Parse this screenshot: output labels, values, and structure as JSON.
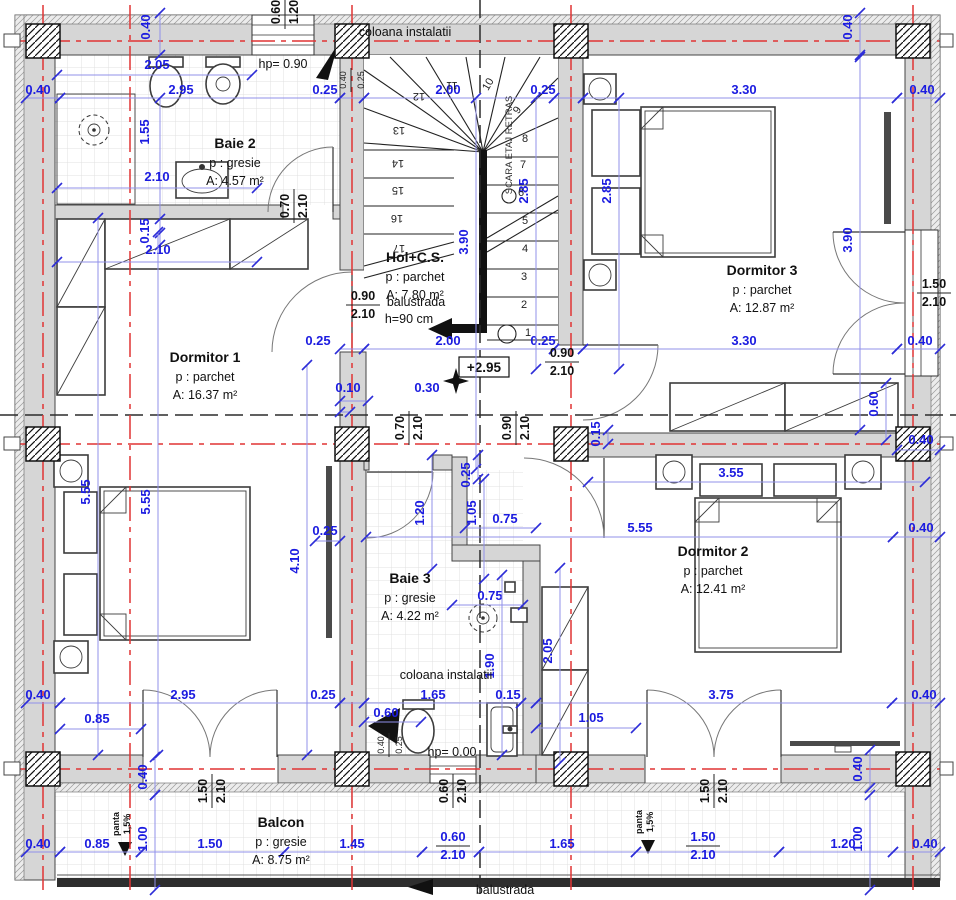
{
  "drawing": {
    "level_marker": "+2.95",
    "colors": {
      "dim_blue": "#1b1be0",
      "axis_red": "#e03434",
      "wall_gray": "#d6d6d6",
      "hatch_black": "#111111"
    }
  },
  "rooms": [
    {
      "name": "Baie 2",
      "floor": "p : gresie",
      "area": "A: 4.57 m²",
      "x": 235,
      "y": 148
    },
    {
      "name": "Hol+C.S.",
      "floor": "p : parchet",
      "area": "A: 7.80 m²",
      "x": 415,
      "y": 262
    },
    {
      "name": "Dormitor 3",
      "floor": "p : parchet",
      "area": "A: 12.87 m²",
      "x": 762,
      "y": 275
    },
    {
      "name": "Dormitor 1",
      "floor": "p : parchet",
      "area": "A: 16.37 m²",
      "x": 205,
      "y": 362
    },
    {
      "name": "Dormitor 2",
      "floor": "p : parchet",
      "area": "A: 12.41 m²",
      "x": 713,
      "y": 556
    },
    {
      "name": "Baie 3",
      "floor": "p : gresie",
      "area": "A: 4.22 m²",
      "x": 410,
      "y": 583
    },
    {
      "name": "Balcon",
      "floor": "p : gresie",
      "area": "A: 8.75 m²",
      "x": 281,
      "y": 827
    }
  ],
  "annotations": [
    {
      "t": "coloana instalatii",
      "x": 405,
      "y": 36,
      "r": 0,
      "c": "ann"
    },
    {
      "t": "coloana instalatii",
      "x": 446,
      "y": 679,
      "r": 0,
      "c": "ann"
    },
    {
      "t": "hp= 0.90",
      "x": 283,
      "y": 68,
      "r": 0,
      "c": "ann"
    },
    {
      "t": "hp= 0.00",
      "x": 452,
      "y": 756,
      "r": 0,
      "c": "ann"
    },
    {
      "t": "balustrada",
      "x": 416,
      "y": 306,
      "r": 0,
      "c": "ann"
    },
    {
      "t": "h=90 cm",
      "x": 409,
      "y": 323,
      "r": 0,
      "c": "ann"
    },
    {
      "t": "balustrada",
      "x": 505,
      "y": 894,
      "r": 0,
      "c": "ann"
    },
    {
      "t": "SCARA ETAJ RETRAS",
      "x": 512,
      "y": 145,
      "r": -90,
      "c": "ann-s"
    },
    {
      "t": "panta",
      "x": 119,
      "y": 824,
      "r": -90,
      "c": "ann-p"
    },
    {
      "t": "1,5%",
      "x": 130,
      "y": 824,
      "r": -90,
      "c": "ann-p"
    },
    {
      "t": "panta",
      "x": 642,
      "y": 822,
      "r": -90,
      "c": "ann-p"
    },
    {
      "t": "1,5%",
      "x": 653,
      "y": 822,
      "r": -90,
      "c": "ann-p"
    }
  ],
  "dims": [
    {
      "t": "0.40",
      "x": 38,
      "y": 94,
      "l": [
        26,
        98,
        60,
        98
      ]
    },
    {
      "t": "2.95",
      "x": 181,
      "y": 94,
      "l": [
        60,
        98,
        340,
        98
      ]
    },
    {
      "t": "0.25",
      "x": 325,
      "y": 94,
      "l": [
        340,
        98,
        364,
        98
      ]
    },
    {
      "t": "2.00",
      "x": 448,
      "y": 94,
      "l": [
        364,
        98,
        554,
        98
      ]
    },
    {
      "t": "0.25",
      "x": 543,
      "y": 94,
      "l": [
        554,
        98,
        583,
        98
      ]
    },
    {
      "t": "3.30",
      "x": 744,
      "y": 94,
      "l": [
        583,
        98,
        897,
        98
      ]
    },
    {
      "t": "0.40",
      "x": 922,
      "y": 94,
      "l": [
        897,
        98,
        940,
        98
      ]
    },
    {
      "t": "0.25",
      "x": 318,
      "y": 345,
      "l": [
        340,
        349,
        364,
        349
      ]
    },
    {
      "t": "2.00",
      "x": 448,
      "y": 345,
      "l": [
        364,
        349,
        554,
        349
      ]
    },
    {
      "t": "0.25",
      "x": 543,
      "y": 345,
      "l": [
        554,
        349,
        583,
        349
      ]
    },
    {
      "t": "3.30",
      "x": 744,
      "y": 345,
      "l": [
        583,
        349,
        897,
        349
      ]
    },
    {
      "t": "0.40",
      "x": 920,
      "y": 345,
      "l": [
        897,
        349,
        940,
        349
      ]
    },
    {
      "t": "0.30",
      "x": 427,
      "y": 392,
      "l": [
        340,
        401,
        368,
        401
      ]
    },
    {
      "t": "0.10",
      "x": 348,
      "y": 392,
      "l": [
        340,
        412,
        350,
        412
      ]
    },
    {
      "t": "2.05",
      "x": 157,
      "y": 69,
      "l": [
        57,
        75,
        252,
        75
      ]
    },
    {
      "t": "1.55",
      "x": 149,
      "y": 132,
      "r": -90,
      "l": [
        160,
        98,
        160,
        245
      ]
    },
    {
      "t": "2.10",
      "x": 157,
      "y": 181,
      "l": [
        57,
        188,
        257,
        188
      ]
    },
    {
      "t": "0.15",
      "x": 149,
      "y": 231,
      "r": -90,
      "l": [
        160,
        219,
        160,
        233
      ]
    },
    {
      "t": "2.10",
      "x": 158,
      "y": 254,
      "l": [
        57,
        262,
        257,
        262
      ]
    },
    {
      "t": "0.40",
      "x": 150,
      "y": 27,
      "r": -90,
      "l": [
        160,
        13,
        160,
        55
      ]
    },
    {
      "t": "0.40",
      "x": 852,
      "y": 27,
      "r": -90,
      "l": [
        860,
        13,
        860,
        55
      ]
    },
    {
      "t": "2.85",
      "x": 528,
      "y": 191,
      "r": -90,
      "l": [
        536,
        98,
        536,
        369
      ]
    },
    {
      "t": "2.85",
      "x": 611,
      "y": 191,
      "r": -90,
      "l": [
        619,
        98,
        619,
        369
      ]
    },
    {
      "t": "3.90",
      "x": 468,
      "y": 242,
      "r": -90,
      "l": [
        476,
        98,
        476,
        469
      ]
    },
    {
      "t": "3.90",
      "x": 852,
      "y": 240,
      "r": -90,
      "l": [
        860,
        57,
        860,
        430
      ]
    },
    {
      "t": "0.60",
      "x": 878,
      "y": 404,
      "r": -90,
      "l": [
        886,
        383,
        886,
        440
      ]
    },
    {
      "t": "0.15",
      "x": 600,
      "y": 434,
      "r": -90,
      "l": [
        608,
        430,
        608,
        444
      ]
    },
    {
      "t": "0.40",
      "x": 921,
      "y": 444,
      "l": [
        897,
        450,
        940,
        450
      ]
    },
    {
      "t": "5.55",
      "x": 90,
      "y": 492,
      "r": -90,
      "l": [
        98,
        218,
        98,
        755
      ]
    },
    {
      "t": "5.55",
      "x": 150,
      "y": 502,
      "r": -90,
      "l": [
        158,
        232,
        158,
        755
      ]
    },
    {
      "t": "4.10",
      "x": 299,
      "y": 561,
      "r": -90,
      "l": [
        307,
        365,
        307,
        755
      ]
    },
    {
      "t": "0.25",
      "x": 325,
      "y": 535,
      "l": [
        315,
        541,
        340,
        541
      ]
    },
    {
      "t": "3.55",
      "x": 731,
      "y": 477,
      "l": [
        588,
        482,
        925,
        482
      ]
    },
    {
      "t": "5.55",
      "x": 640,
      "y": 532,
      "l": [
        366,
        537,
        893,
        537
      ]
    },
    {
      "t": "0.40",
      "x": 921,
      "y": 532,
      "l": [
        893,
        537,
        940,
        537
      ]
    },
    {
      "t": "1.20",
      "x": 424,
      "y": 513,
      "r": -90,
      "l": [
        432,
        455,
        432,
        569
      ]
    },
    {
      "t": "0.25",
      "x": 470,
      "y": 475,
      "r": -90,
      "l": [
        478,
        455,
        478,
        479
      ]
    },
    {
      "t": "1.05",
      "x": 476,
      "y": 513,
      "r": -90,
      "l": [
        484,
        479,
        484,
        579
      ]
    },
    {
      "t": "0.75",
      "x": 505,
      "y": 523,
      "l": [
        465,
        528,
        536,
        528
      ]
    },
    {
      "t": "0.75",
      "x": 490,
      "y": 600,
      "l": [
        452,
        605,
        523,
        605
      ]
    },
    {
      "t": "2.05",
      "x": 552,
      "y": 651,
      "r": -90,
      "l": [
        560,
        568,
        560,
        763
      ]
    },
    {
      "t": "1.90",
      "x": 494,
      "y": 666,
      "r": -90,
      "l": [
        502,
        575,
        502,
        755
      ]
    },
    {
      "t": "0.40",
      "x": 38,
      "y": 699,
      "l": [
        26,
        703,
        60,
        703
      ]
    },
    {
      "t": "2.95",
      "x": 183,
      "y": 699,
      "l": [
        60,
        703,
        340,
        703
      ]
    },
    {
      "t": "0.25",
      "x": 323,
      "y": 699,
      "l": [
        340,
        703,
        364,
        703
      ]
    },
    {
      "t": "1.65",
      "x": 433,
      "y": 699,
      "l": [
        364,
        703,
        521,
        703
      ]
    },
    {
      "t": "0.15",
      "x": 508,
      "y": 699,
      "l": [
        521,
        703,
        536,
        703
      ]
    },
    {
      "t": "3.75",
      "x": 721,
      "y": 699,
      "l": [
        536,
        703,
        892,
        703
      ]
    },
    {
      "t": "0.40",
      "x": 924,
      "y": 699,
      "l": [
        892,
        703,
        940,
        703
      ]
    },
    {
      "t": "0.85",
      "x": 97,
      "y": 723,
      "l": [
        60,
        729,
        141,
        729
      ]
    },
    {
      "t": "1.05",
      "x": 591,
      "y": 722,
      "l": [
        536,
        728,
        636,
        728
      ]
    },
    {
      "t": "0.60",
      "x": 386,
      "y": 717,
      "l": [
        364,
        722,
        421,
        722
      ]
    },
    {
      "t": "0.40",
      "x": 147,
      "y": 777,
      "r": -90,
      "l": [
        155,
        757,
        155,
        795
      ]
    },
    {
      "t": "1.00",
      "x": 147,
      "y": 839,
      "r": -90,
      "l": [
        155,
        795,
        155,
        890
      ]
    },
    {
      "t": "0.40",
      "x": 862,
      "y": 769,
      "r": -90,
      "l": [
        870,
        750,
        870,
        788
      ]
    },
    {
      "t": "1.00",
      "x": 862,
      "y": 839,
      "r": -90,
      "l": [
        870,
        795,
        870,
        890
      ]
    },
    {
      "t": "0.40",
      "x": 38,
      "y": 848,
      "l": [
        26,
        852,
        60,
        852
      ]
    },
    {
      "t": "0.85",
      "x": 97,
      "y": 848,
      "l": [
        60,
        852,
        141,
        852
      ]
    },
    {
      "t": "1.50",
      "x": 210,
      "y": 848,
      "l": [
        141,
        852,
        284,
        852
      ]
    },
    {
      "t": "1.45",
      "x": 352,
      "y": 848,
      "l": [
        284,
        852,
        422,
        852
      ]
    },
    {
      "t": "1.65",
      "x": 562,
      "y": 848,
      "l": [
        479,
        852,
        636,
        852
      ]
    },
    {
      "t": "1.20",
      "x": 843,
      "y": 848,
      "l": [
        779,
        852,
        893,
        852
      ]
    },
    {
      "t": "0.40",
      "x": 925,
      "y": 848,
      "l": [
        893,
        852,
        940,
        852
      ]
    }
  ],
  "fractions": [
    {
      "a": "0.60",
      "b": "1.20",
      "x": 283,
      "y": 12,
      "r": -90,
      "k": "b"
    },
    {
      "a": "0.70",
      "b": "2.10",
      "x": 292,
      "y": 206,
      "r": -90,
      "k": "b"
    },
    {
      "a": "0.90",
      "b": "2.10",
      "x": 363,
      "y": 303,
      "r": 0,
      "k": "b"
    },
    {
      "a": "0.90",
      "b": "2.10",
      "x": 562,
      "y": 360,
      "r": 0,
      "k": "b"
    },
    {
      "a": "0.70",
      "b": "2.10",
      "x": 407,
      "y": 428,
      "r": -90,
      "k": "b"
    },
    {
      "a": "0.90",
      "b": "2.10",
      "x": 514,
      "y": 428,
      "r": -90,
      "k": "b"
    },
    {
      "a": "1.50",
      "b": "2.10",
      "x": 934,
      "y": 291,
      "r": 0,
      "k": "b"
    },
    {
      "a": "1.50",
      "b": "2.10",
      "x": 210,
      "y": 791,
      "r": -90,
      "k": "b"
    },
    {
      "a": "1.50",
      "b": "2.10",
      "x": 712,
      "y": 791,
      "r": -90,
      "k": "b"
    },
    {
      "a": "0.60",
      "b": "2.10",
      "x": 451,
      "y": 791,
      "r": -90,
      "k": "b"
    },
    {
      "a": "0.60",
      "b": "2.10",
      "x": 453,
      "y": 844,
      "r": 0,
      "k": "blue",
      "l": [
        422,
        852,
        479,
        852
      ]
    },
    {
      "a": "1.50",
      "b": "2.10",
      "x": 703,
      "y": 844,
      "r": 0,
      "k": "blue",
      "l": [
        636,
        852,
        779,
        852
      ]
    },
    {
      "a": "0.40",
      "b": "0.25",
      "x": 349,
      "y": 80,
      "r": -90,
      "k": "s"
    },
    {
      "a": "0.40",
      "b": "0.25",
      "x": 387,
      "y": 745,
      "r": -90,
      "k": "s"
    }
  ],
  "stairs": {
    "label": "SCARA ETAJ RETRAS",
    "balustrade_note": "h=90 cm",
    "numbers": [
      {
        "t": "1",
        "x": 528,
        "y": 336,
        "r": 0
      },
      {
        "t": "2",
        "x": 524,
        "y": 308,
        "r": 0
      },
      {
        "t": "3",
        "x": 524,
        "y": 280,
        "r": 0
      },
      {
        "t": "4",
        "x": 525,
        "y": 252,
        "r": 0
      },
      {
        "t": "5",
        "x": 525,
        "y": 224,
        "r": 0
      },
      {
        "t": "6",
        "x": 521,
        "y": 196,
        "r": 0
      },
      {
        "t": "7",
        "x": 523,
        "y": 168,
        "r": 0
      },
      {
        "t": "8",
        "x": 525,
        "y": 142,
        "r": 0
      },
      {
        "t": "9",
        "x": 520,
        "y": 112,
        "r": -55
      },
      {
        "t": "10",
        "x": 491,
        "y": 86,
        "r": -60
      },
      {
        "t": "11",
        "x": 452,
        "y": 82,
        "r": 180
      },
      {
        "t": "12",
        "x": 419,
        "y": 93,
        "r": 180
      },
      {
        "t": "13",
        "x": 399,
        "y": 127,
        "r": 180
      },
      {
        "t": "14",
        "x": 398,
        "y": 160,
        "r": 180
      },
      {
        "t": "15",
        "x": 398,
        "y": 187,
        "r": 180
      },
      {
        "t": "16",
        "x": 397,
        "y": 215,
        "r": 180
      },
      {
        "t": "17",
        "x": 399,
        "y": 245,
        "r": 180
      }
    ]
  }
}
